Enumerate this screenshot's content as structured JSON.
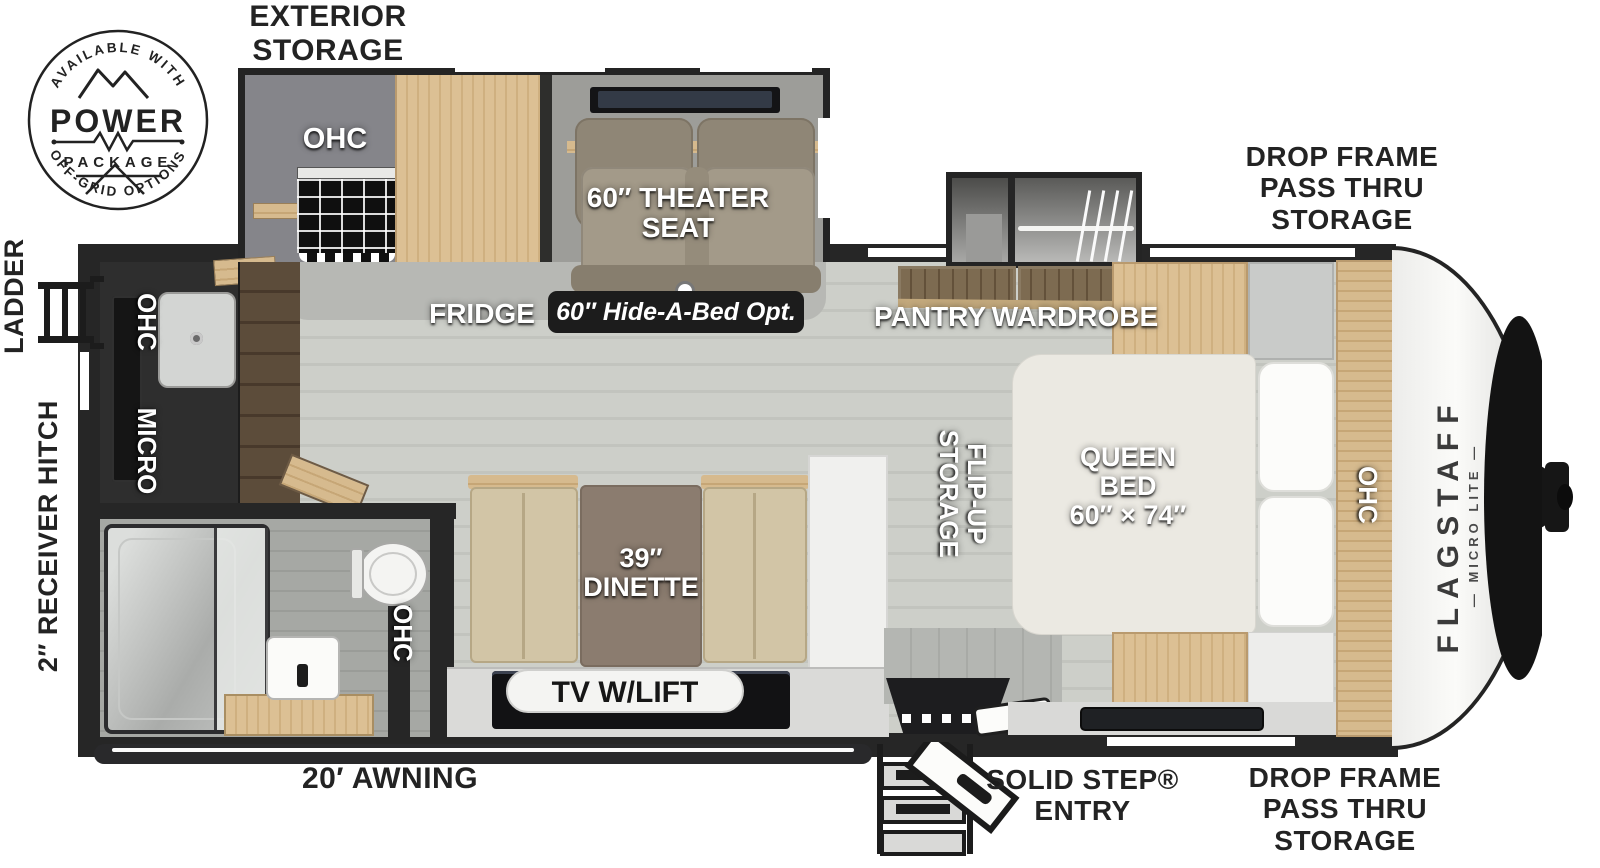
{
  "badge": {
    "top_arc": "AVAILABLE WITH",
    "title": "POWER",
    "subtitle": "PACKAGE",
    "bottom_arc": "OFF-GRID OPTIONS"
  },
  "labels": {
    "exterior_storage": "EXTERIOR\nSTORAGE",
    "drop_frame_top": "DROP FRAME\nPASS THRU\nSTORAGE",
    "drop_frame_bottom": "DROP FRAME\nPASS THRU\nSTORAGE",
    "ladder": "LADDER",
    "receiver_hitch": "2″ RECEIVER HITCH",
    "awning": "20′ AWNING",
    "solid_step": "SOLID STEP®\nENTRY",
    "ohc_slide": "OHC",
    "theater_seat": "60″ THEATER\nSEAT",
    "fridge": "FRIDGE",
    "hide_a_bed": "60″ Hide-A-Bed Opt.",
    "pantry": "PANTRY",
    "wardrobe": "WARDROBE",
    "ohc_rear": "OHC",
    "micro": "MICRO",
    "ohc_bath": "OHC",
    "dinette": "39″\nDINETTE",
    "tv_lift": "TV W/LIFT",
    "flip_up_storage": "FLIP-UP\nSTORAGE",
    "queen_bed": "QUEEN\nBED\n60″ × 74″",
    "ohc_bed": "OHC",
    "brand": "FLAGSTAFF",
    "brand_sub": "— MICRO LITE —"
  },
  "colors": {
    "wall": "#262626",
    "floor": "#c9cbc5",
    "carpet": "#b7b8b4",
    "wood_light": "#d6bb8e",
    "wood_dark": "#6f5d46",
    "theater_seat": "#9a9181",
    "dinette_bench": "#d2c5a6",
    "dinette_table": "#8b7c6f",
    "mattress": "#ebe9e2",
    "label_black": "#232323",
    "pill_dark": "#1c1c1c",
    "front_cap": "#f7f7f5"
  }
}
